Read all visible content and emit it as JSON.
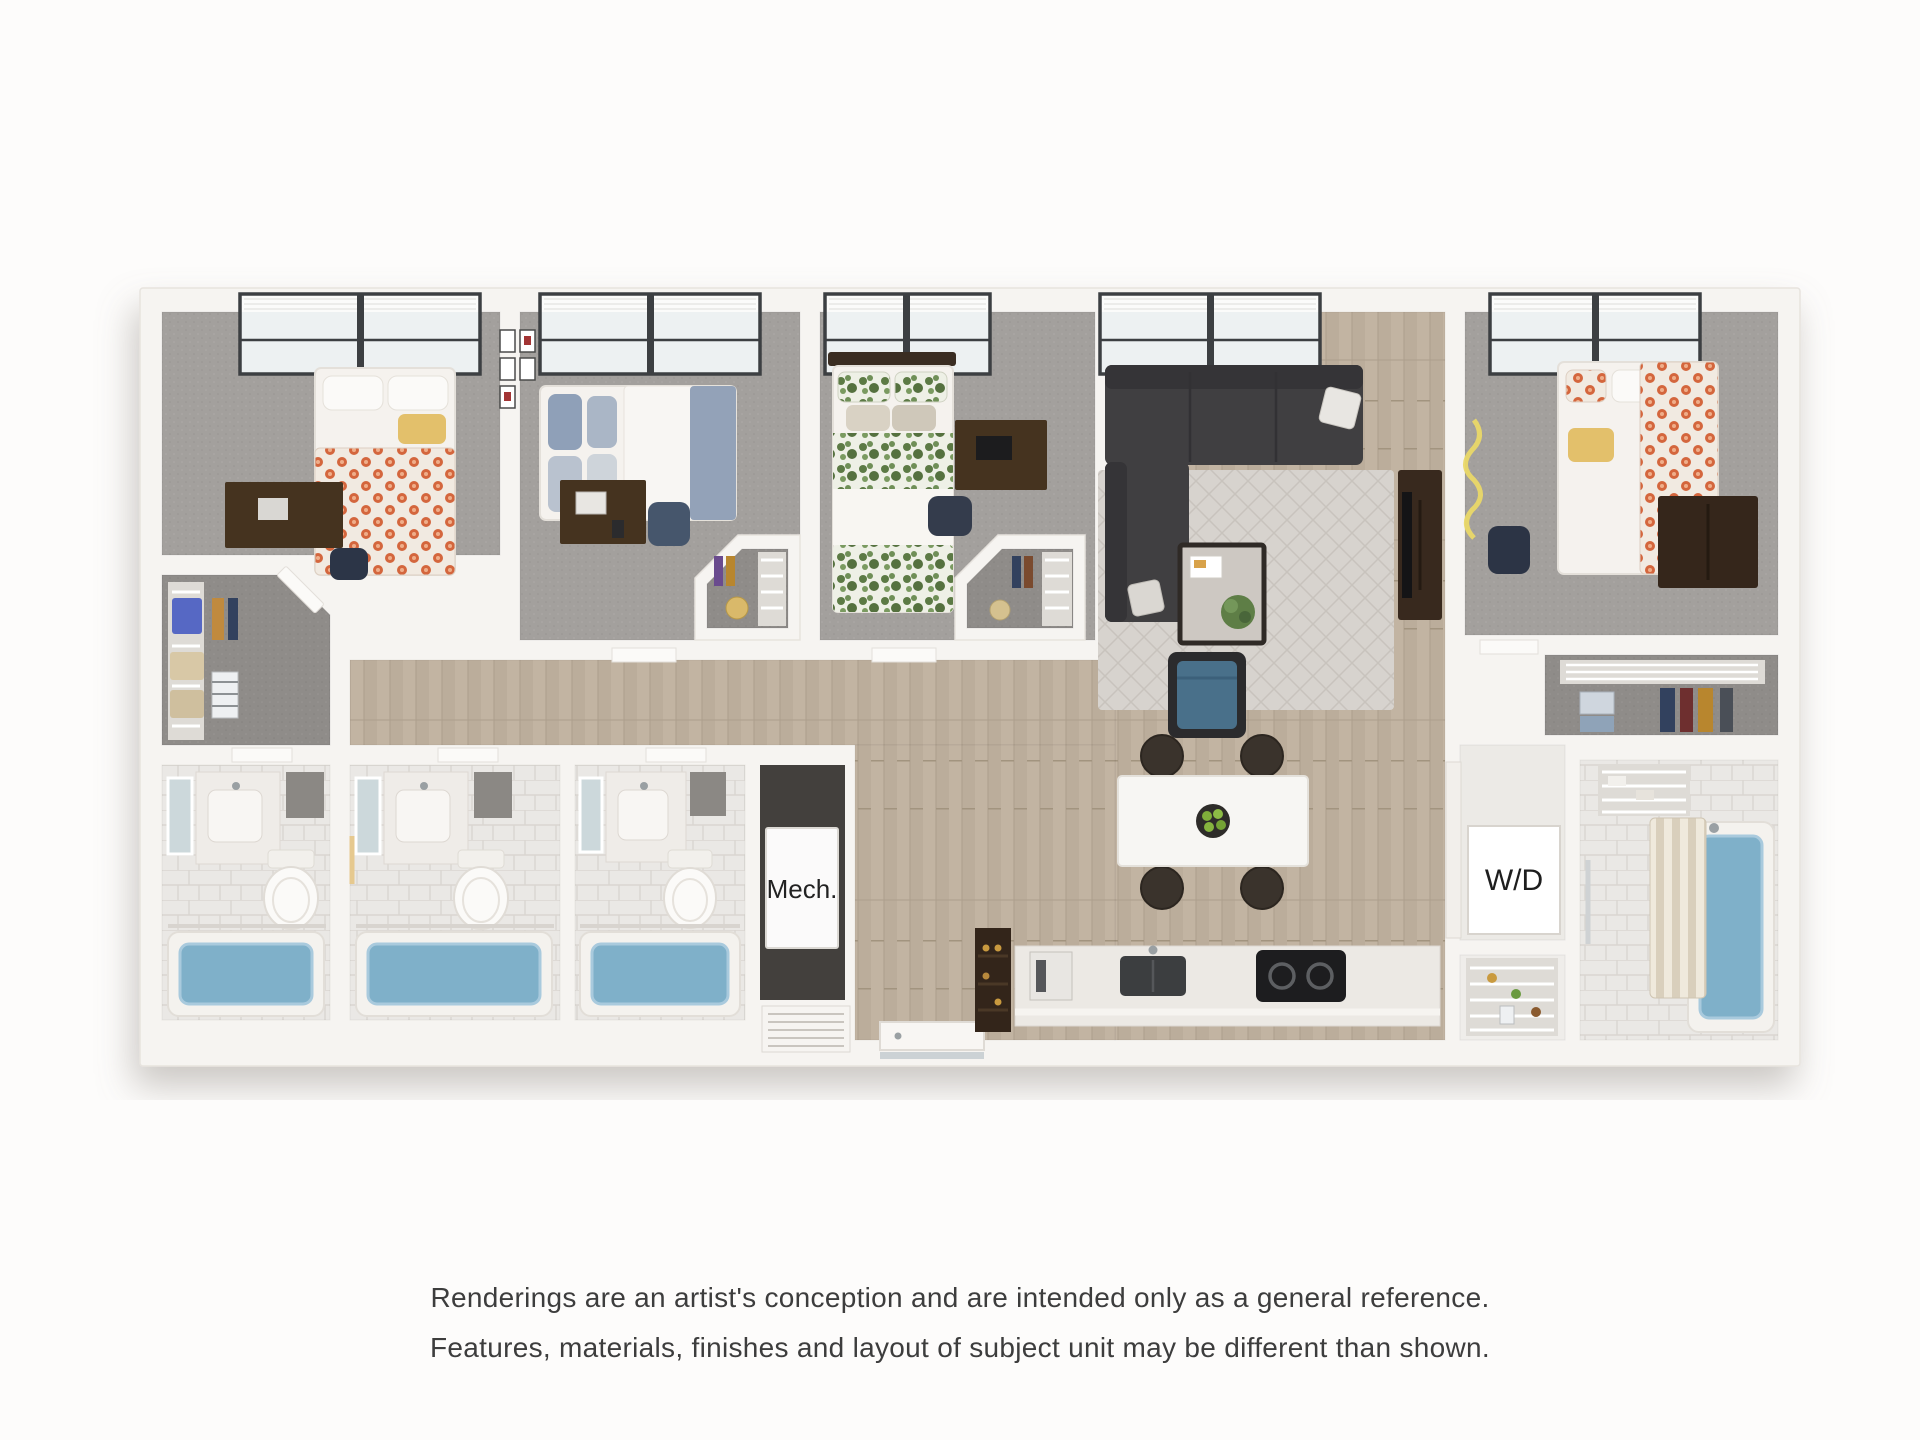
{
  "page": {
    "background": "#fdfcfb"
  },
  "floor_plan": {
    "kind": "3d-floor-plan-rendering",
    "labels": {
      "washer_dryer": "W/D",
      "mechanical": "Mech."
    },
    "palette": {
      "wall_white": "#f6f4f1",
      "wood_floor": "#c0b2a0",
      "bedroom_carpet": "#a3a09d",
      "bathroom_tile": "#eae8e5",
      "bathtub_blue": "#7fb0c9",
      "sofa_charcoal": "#403f41",
      "accent_chair_blue": "#49708a",
      "duvet_orange": "#d4663d",
      "duvet_green": "#5c7a45",
      "duvet_blue_gray": "#98a7bc",
      "accent_yellow": "#e3c06b",
      "dark_wood_furniture": "#45331f"
    }
  },
  "disclaimer": {
    "line1": "Renderings are an artist's conception and are intended only as a general reference.",
    "line2": "Features, materials, finishes and layout of subject unit may be different than shown."
  }
}
